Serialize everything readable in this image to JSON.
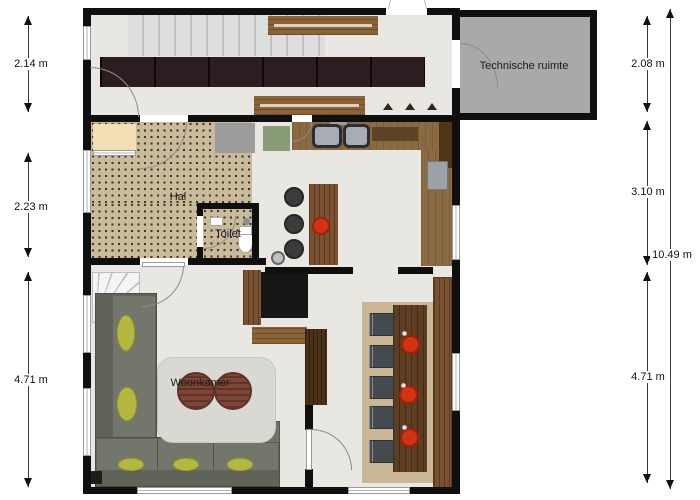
{
  "rooms": {
    "technical_room_label": "Technische ruimte",
    "hall_label": "Hal",
    "toilet_label": "Toilet",
    "living_room_label": "Woonkamer"
  },
  "dimensions": {
    "left": [
      "2.14 m",
      "2.23 m",
      "4.71 m"
    ],
    "right": [
      "2.08 m",
      "3.10 m",
      "4.71 m"
    ],
    "total_right": "10.49 m"
  },
  "colors": {
    "wall": "#0f0f0f",
    "floor": "#e9e7e2",
    "hall_floor": "#c9ba9c",
    "technical_room_floor": "#a9a9a9",
    "counter_wood": "#8a6a42",
    "dark_wood": "#4c3018",
    "wardrobe": "#241418",
    "sofa": "#6e7267",
    "cushion": "#b5b83e",
    "accent_red": "#d23413",
    "living_rug": "#d9d8d3",
    "dining_rug": "#c9b795",
    "mat_green": "#8a9b78",
    "mat_cream": "#f3deb5"
  }
}
